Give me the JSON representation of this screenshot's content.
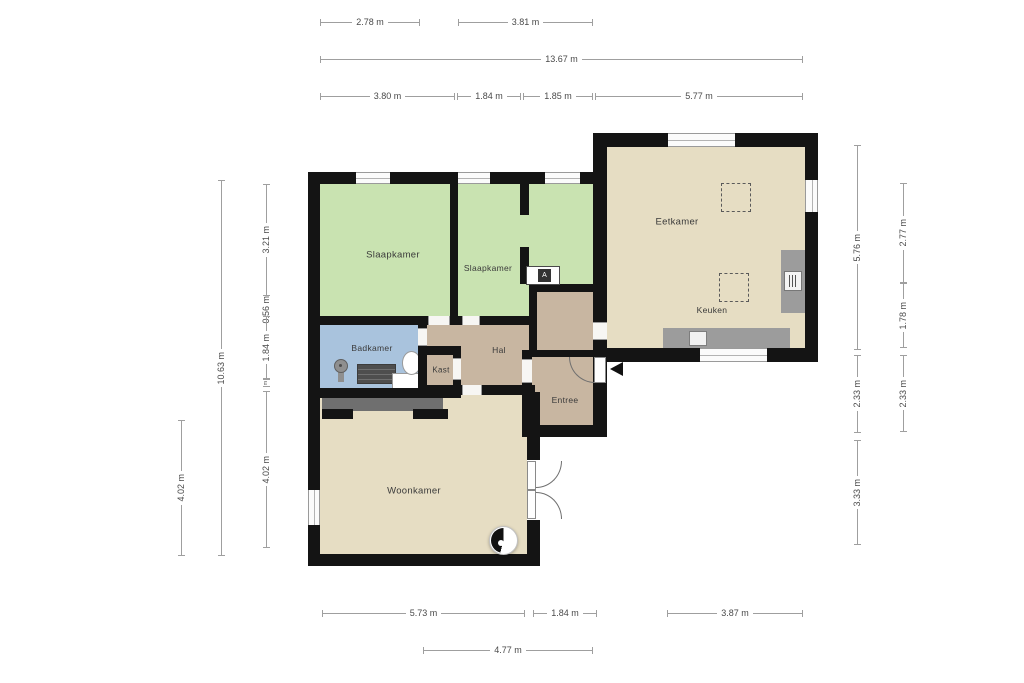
{
  "plan": {
    "type": "floorplan",
    "language": "nl",
    "rooms": {
      "slaapkamer1": "Slaapkamer",
      "slaapkamer2": "Slaapkamer",
      "badkamer": "Badkamer",
      "kast": "Kast",
      "hal": "Hal",
      "entree": "Entree",
      "woonkamer": "Woonkamer",
      "eetkamer": "Eetkamer",
      "keuken": "Keuken"
    },
    "boiler_symbol": "A",
    "colors": {
      "wall": "#141414",
      "bedroom_floor": "#c9e3b1",
      "bathroom_floor": "#a9c3dd",
      "hall_floor": "#c8b6a1",
      "living_floor": "#e6ddc3",
      "closet_floor": "#ececea",
      "counter": "#9c9c9c",
      "wardrobe": "#6f6f6f",
      "dimension_line": "#9f9f9f"
    },
    "dims": {
      "top1": [
        "2.78 m",
        "3.81 m"
      ],
      "top2": [
        "13.67 m"
      ],
      "top3": [
        "3.80 m",
        "1.84 m",
        "1.85 m",
        "5.77 m"
      ],
      "left_outer": [
        "4.02 m"
      ],
      "left_mid": [
        "10.63 m"
      ],
      "left_inner": [
        "3.21 m",
        "0.56 m",
        "1.84 m",
        "m",
        "4.02 m"
      ],
      "right_inner": [
        "5.76 m",
        "2.33 m",
        "3.33 m"
      ],
      "right_outer": [
        "2.77 m",
        "1.78 m",
        "2.33 m"
      ],
      "bottom1": [
        "5.73 m",
        "1.84 m",
        "3.87 m"
      ],
      "bottom2": [
        "4.77 m"
      ]
    }
  }
}
